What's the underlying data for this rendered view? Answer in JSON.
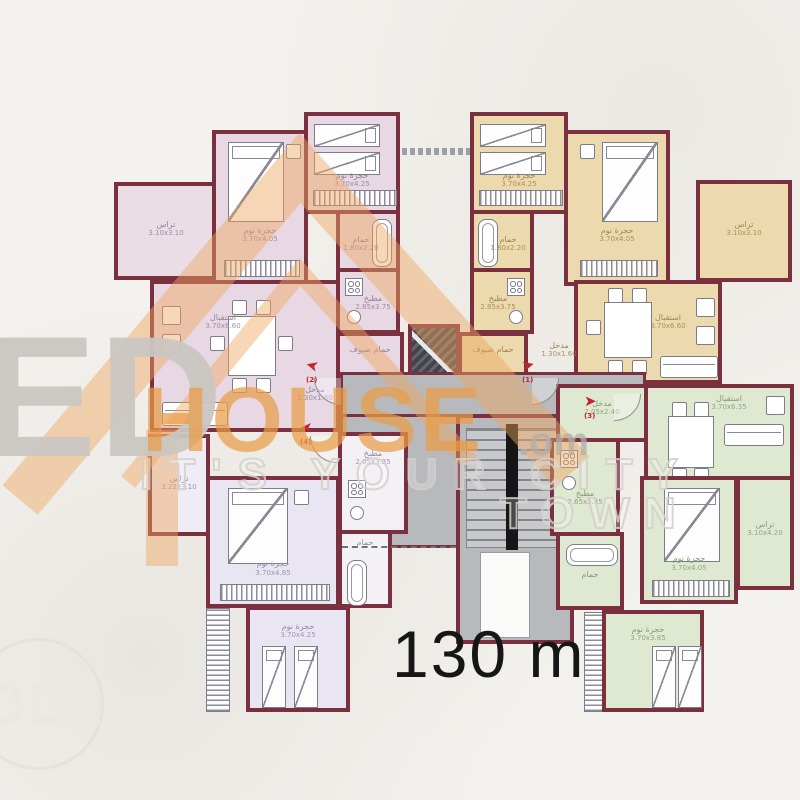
{
  "area_label": "130 m",
  "watermark": {
    "big_letters": "ED",
    "brand": "HOUSE",
    "domain_suffix": ".om",
    "tagline_line1": "IT'S YOUR CITY",
    "tagline_line2": "TOWN",
    "corner_logo": "OLX",
    "orange_color": "#e99d46",
    "gray_color": "#c9c6c1"
  },
  "colors": {
    "wall": "#7b3040",
    "unit_top_left": "#e7d8e3",
    "unit_top_right": "#ecd9ae",
    "unit_bottom_left": "#e9e5f2",
    "unit_bottom_right": "#dfe8d1",
    "core_gray": "#b7b9bc",
    "entrance_arrow_red": "#c4242b"
  },
  "rooms": [
    {
      "id": "tl-terrace",
      "label": "تراس",
      "dims": "3.10x3.10"
    },
    {
      "id": "tl-bed1",
      "label": "حجرة نوم",
      "dims": "3.70x4.05"
    },
    {
      "id": "tl-bed2",
      "label": "حجرة نوم",
      "dims": "3.70x4.25"
    },
    {
      "id": "tl-bath",
      "label": "حمام",
      "dims": "1.80x2.20"
    },
    {
      "id": "tl-kitchen",
      "label": "مطبخ",
      "dims": "2.85x3.75"
    },
    {
      "id": "tl-living",
      "label": "استقبال",
      "dims": "3.70x6.60"
    },
    {
      "id": "tl-hall",
      "label": "مدخل",
      "dims": "1.30x1.60"
    },
    {
      "id": "tl-guestbath",
      "label": "حمام ضيوف",
      "dims": "1.40x1.90"
    },
    {
      "id": "tr-bed2",
      "label": "حجرة نوم",
      "dims": "3.70x4.25"
    },
    {
      "id": "tr-bed1",
      "label": "حجرة نوم",
      "dims": "3.70x4.05"
    },
    {
      "id": "tr-terrace",
      "label": "تراس",
      "dims": "3.10x3.10"
    },
    {
      "id": "tr-bath",
      "label": "حمام",
      "dims": "1.80x2.20"
    },
    {
      "id": "tr-kitchen",
      "label": "مطبخ",
      "dims": "2.85x3.75"
    },
    {
      "id": "tr-hall",
      "label": "مدخل",
      "dims": "1.30x1.60"
    },
    {
      "id": "tr-living",
      "label": "استقبال",
      "dims": "3.70x6.60"
    },
    {
      "id": "tr-guestbath",
      "label": "حمام ضيوف",
      "dims": "1.40x1.90"
    },
    {
      "id": "core-hall",
      "label": "مدخل",
      "dims": ""
    },
    {
      "id": "bl-terrace",
      "label": "تراس",
      "dims": "3.22x3.10"
    },
    {
      "id": "bl-bed1",
      "label": "حجرة نوم",
      "dims": "3.70x4.85"
    },
    {
      "id": "bl-bed2",
      "label": "حجرة نوم",
      "dims": "3.70x4.25"
    },
    {
      "id": "bl-kitchen",
      "label": "مطبخ",
      "dims": "2.65x3.35"
    },
    {
      "id": "bl-bath",
      "label": "حمام",
      "dims": "1.80x2.20"
    },
    {
      "id": "br-hall",
      "label": "مدخل",
      "dims": "2.05x2.40"
    },
    {
      "id": "br-living",
      "label": "استقبال",
      "dims": "3.70x6.35"
    },
    {
      "id": "br-kitchen",
      "label": "مطبخ",
      "dims": "2.65x3.35"
    },
    {
      "id": "br-bed1",
      "label": "حجرة نوم",
      "dims": "3.70x4.05"
    },
    {
      "id": "br-terrace",
      "label": "تراس",
      "dims": "3.10x4.20"
    },
    {
      "id": "br-bath",
      "label": "حمام",
      "dims": "1.80x2.20"
    },
    {
      "id": "br-bed2",
      "label": "حجرة نوم",
      "dims": "3.70x3.85"
    }
  ],
  "entrances": [
    {
      "num": "(2)"
    },
    {
      "num": "(4)"
    },
    {
      "num": "(1)"
    },
    {
      "num": "(3)"
    }
  ]
}
